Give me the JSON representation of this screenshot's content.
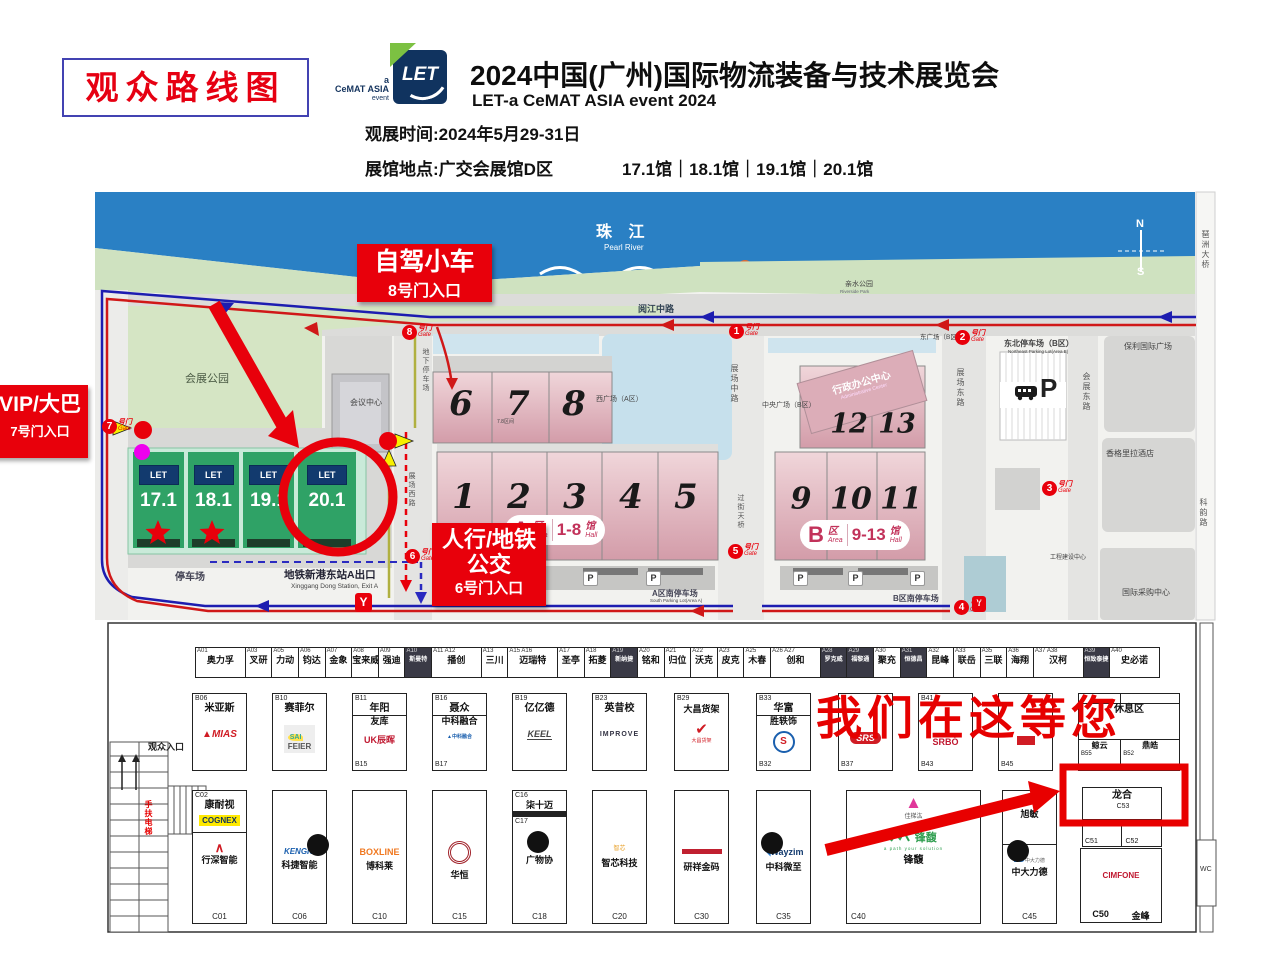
{
  "header": {
    "route_box": "观众路线图",
    "logo": {
      "let": "LET",
      "a": "a",
      "cemat": "CeMAT ASIA",
      "event": "event"
    },
    "title": "2024中国(广州)国际物流装备与技术展览会",
    "subtitle": "LET-a CeMAT ASIA event 2024",
    "time_line": "观展时间:2024年5月29-31日",
    "venue_line": "展馆地点:广交会展馆D区",
    "halls_line": "17.1馆｜18.1馆｜19.1馆｜20.1馆"
  },
  "map": {
    "river_zh": "珠 江",
    "river_en": "Pearl River",
    "compass_n": "N",
    "compass_s": "S",
    "let_mini": "LET",
    "callouts": {
      "car1": "自驾小车",
      "car2": "8号门入口",
      "vip1": "VIP/大巴",
      "vip2": "7号门入口",
      "walk1": "人行/地铁",
      "walk2": "公交",
      "walk3": "6号门入口"
    },
    "gates": [
      "1",
      "2",
      "3",
      "4",
      "5",
      "6",
      "7",
      "8"
    ],
    "gate_zh": "号门",
    "gate_en": "Gate",
    "halls_top": [
      "6",
      "7",
      "8"
    ],
    "halls_a": [
      "1",
      "2",
      "3",
      "4",
      "5"
    ],
    "halls_b_up": [
      "12",
      "13"
    ],
    "halls_b_low": [
      "9",
      "10",
      "11"
    ],
    "green_halls": [
      "17.1",
      "18.1",
      "19.1",
      "20.1"
    ],
    "area_a": {
      "letter": "A",
      "qu": "区",
      "area": "Area",
      "range": "1-8",
      "guan": "馆",
      "hall": "Hall"
    },
    "area_b": {
      "letter": "B",
      "qu": "区",
      "area": "Area",
      "range": "9-13",
      "guan": "馆",
      "hall": "Hall"
    },
    "admin_zh": "行政办公中心",
    "admin_en": "Administrative Center",
    "labels": {
      "park": "会展公园",
      "conference": "会议中心",
      "riverside_zh": "亲水公园",
      "riverside_en": "Riverside Park",
      "yuejiang": "阅江中路",
      "zhanchang_mid": "展场中路",
      "flyover": "过街天桥",
      "zhanchang_east": "展场东路",
      "zhanchang_west": "展场西路",
      "huizhan_east": "会展东路",
      "keyun": "科韵路",
      "pazhou": "琶洲大桥",
      "poly": "保利国际广场",
      "shangrila": "香格里拉酒店",
      "intl_sourcing": "国际采购中心",
      "ne_parking": "东北停车场（B区）",
      "ne_parking_en": "Northeast Parking Lot(Area B)",
      "west_square": "西广场（A区）",
      "central_square": "中央广场（B区）",
      "east_square": "东广场（B区）",
      "underground": "地下停车场",
      "a_south": "A区南停车场",
      "a_south_en": "South Parking Lot(Area A)",
      "b_south": "B区南停车场",
      "eng_center": "工程建设中心",
      "parking": "停车场",
      "interval": "7.8区间",
      "metro_zh": "地铁新港东站A出口",
      "metro_en": "Xinggang Dong Station, Exit A",
      "p": "P",
      "metro_y": "Y"
    }
  },
  "floor": {
    "entrance": "观众入口",
    "escalator": "手扶电梯",
    "wc": "WC",
    "overlay": "我们在这等您",
    "row_a": [
      {
        "code": "A01",
        "name": "奥力孚",
        "mod": "w2"
      },
      {
        "code": "A03",
        "name": "叉研"
      },
      {
        "code": "A05",
        "name": "力动"
      },
      {
        "code": "A06",
        "name": "钧达"
      },
      {
        "code": "A07",
        "name": "金象"
      },
      {
        "code": "A08",
        "name": "宝来威"
      },
      {
        "code": "A09",
        "name": "强迪"
      },
      {
        "code": "A10",
        "name": "斯曼特",
        "mod": "dk"
      },
      {
        "code": "A11 A12",
        "name": "播创",
        "mod": "w2"
      },
      {
        "code": "A13",
        "name": "三川"
      },
      {
        "code": "A15 A16",
        "name": "迈瑞特",
        "mod": "w2"
      },
      {
        "code": "A17",
        "name": "圣亭"
      },
      {
        "code": "A18",
        "name": "拓菱"
      },
      {
        "code": "A19",
        "name": "新纳捷",
        "mod": "dk"
      },
      {
        "code": "A20",
        "name": "铭和"
      },
      {
        "code": "A21",
        "name": "归位"
      },
      {
        "code": "A22",
        "name": "沃克"
      },
      {
        "code": "A23",
        "name": "皮克"
      },
      {
        "code": "A25",
        "name": "木春"
      },
      {
        "code": "A26 A27",
        "name": "创和",
        "mod": "w2"
      },
      {
        "code": "A28",
        "name": "罗克威",
        "mod": "dk"
      },
      {
        "code": "A29",
        "name": "福黎通",
        "mod": "dk"
      },
      {
        "code": "A30",
        "name": "聚充"
      },
      {
        "code": "A31",
        "name": "恒德昌",
        "mod": "dk"
      },
      {
        "code": "A32",
        "name": "昆峰"
      },
      {
        "code": "A33",
        "name": "联岳"
      },
      {
        "code": "A35",
        "name": "三联"
      },
      {
        "code": "A36",
        "name": "海翔"
      },
      {
        "code": "A37 A38",
        "name": "汉柯",
        "mod": "w2"
      },
      {
        "code": "A39",
        "name": "恒致泰捷",
        "mod": "dk"
      },
      {
        "code": "A40",
        "name": "史必诺",
        "mod": "w2"
      }
    ],
    "b06": {
      "code": "B06",
      "name": "米亚斯",
      "logo": "MIAS"
    },
    "b10": {
      "code": "B10",
      "name": "赛菲尔",
      "logo1": "SAI",
      "logo2": "FEIER"
    },
    "b11": {
      "code": "B11",
      "name1": "年阳",
      "name2": "友库",
      "logo": "UK辰晖",
      "code2": "B15"
    },
    "b16": {
      "code": "B16",
      "name1": "聂众",
      "name2": "中科融合",
      "logo": "中科融合",
      "code2": "B17"
    },
    "b19": {
      "code": "B19",
      "name": "亿亿德",
      "logo": "KEEL"
    },
    "b23": {
      "code": "B23",
      "name": "英昔校",
      "logo": "IMPROVE"
    },
    "b29": {
      "code": "B29",
      "name": "大昌货架",
      "logo": "✔",
      "logo_sub": "大昌货架"
    },
    "b33": {
      "code": "B33",
      "name1": "华富",
      "name2": "胜轶饰",
      "logo": "S",
      "code2": "B32"
    },
    "b37": {
      "logo": "SRS",
      "code2": "B37"
    },
    "b41": {
      "code": "B41",
      "logo": "SRBÓ",
      "code2": "B43"
    },
    "b45": {
      "code2": "B45"
    },
    "b52": {
      "name": "休息区",
      "cell1_name": "鲸云",
      "cell1_code": "B55",
      "cell2_name": "鼎皓",
      "cell2_code": "B52"
    },
    "c01": {
      "code_top": "C02",
      "name_top": "康耐视",
      "logo_top": "COGNEX",
      "logo_bot": "∧",
      "name_bot": "行深智能",
      "code_bot": "C01"
    },
    "c06": {
      "logo": "KENGIC",
      "name": "科捷智能",
      "code": "C06"
    },
    "c10": {
      "logo": "BOXLINE",
      "name": "博科莱",
      "code": "C10"
    },
    "c15": {
      "name": "华恒",
      "code": "C15"
    },
    "c18": {
      "code_top": "C16",
      "name_top": "柒十迈",
      "code_mid": "C17",
      "name_bot": "广物协",
      "code_bot": "C18"
    },
    "c20": {
      "logo": "智芯",
      "name": "智芯科技",
      "code": "C20"
    },
    "c30": {
      "name": "研祥金码",
      "code": "C30"
    },
    "c35": {
      "logo": "Wayzim",
      "name": "中科微至",
      "code": "C35"
    },
    "c40": {
      "name1": "佳梯汯",
      "logo": "锋馥",
      "tagline": "a path your solution",
      "name2": "锋馥",
      "code": "C40"
    },
    "c45": {
      "name_top": "旭敏",
      "logo": "ZD",
      "logo2": "中大力德",
      "name_bot": "中大力德",
      "code": "C45"
    },
    "c50": {
      "logo": "CIMFONE",
      "code": "C50",
      "name": "金峰"
    },
    "c53": {
      "name": "龙合",
      "code": "C53",
      "cell1": "C51",
      "cell2": "C52"
    }
  }
}
